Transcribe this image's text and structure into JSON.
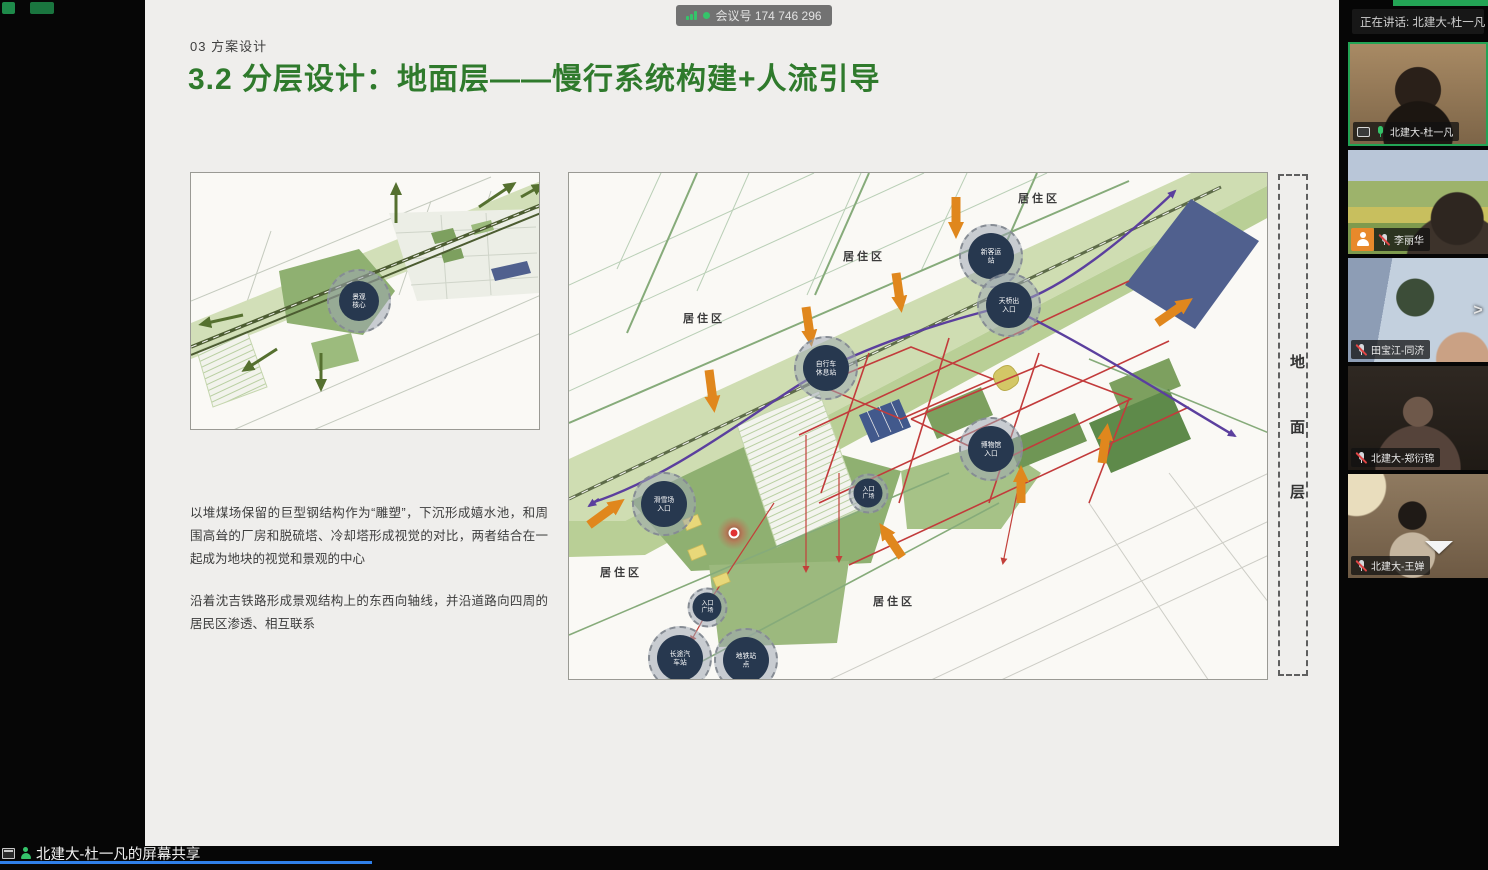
{
  "colors": {
    "title_green": "#2f7a2c",
    "accent_green": "#23a455",
    "flow_orange": "#e0871d",
    "metro_purple": "#5b3f9e",
    "site_red": "#c23b3b",
    "band_green": "#cfddb2",
    "node_navy": "#27384f",
    "taskbar_blue": "#2f7fe8"
  },
  "icons": {
    "signal": "signal-bars-icon",
    "live_dot": "green-dot-icon",
    "mic_on": "mic-icon",
    "mic_muted": "mic-muted-icon",
    "screen_share": "screen-share-icon",
    "hand_raised": "raise-hand-icon",
    "expand": "chevron-right-icon",
    "scroll_more": "triangle-down-icon",
    "window": "window-icon",
    "sharing_user": "person-icon"
  },
  "top_bar": {
    "meeting_label": "会议号 174 746 296"
  },
  "speaking_banner": {
    "text": "正在讲话: 北建大-杜一凡"
  },
  "share_bar": {
    "text": "北建大-杜一凡的屏幕共享"
  },
  "sidebar": {
    "participants": [
      {
        "name": "北建大-杜一凡",
        "mic": "on",
        "sharing": true,
        "speaking": true
      },
      {
        "name": "李丽华",
        "mic": "muted",
        "hand_raised": true
      },
      {
        "name": "田宝江-同济",
        "mic": "muted"
      },
      {
        "name": "北建大-郑衍锦",
        "mic": "muted"
      },
      {
        "name": "北建大-王婵",
        "mic": "muted"
      }
    ]
  },
  "slide": {
    "kicker": "03 方案设计",
    "title": "3.2 分层设计：地面层——慢行系统构建+人流引导",
    "paragraphs": [
      "以堆煤场保留的巨型钢结构作为“雕塑”，下沉形成嬉水池，和周围高耸的厂房和脱硫塔、冷却塔形成视觉的对比，两者结合在一起成为地块的视觉和景观的中心",
      "沿着沈吉铁路形成景观结构上的东西向轴线，并沿道路向四周的居民区渗透、相互联系"
    ],
    "layer_tag": "地面层",
    "small_map": {
      "core_label": "景观核心"
    },
    "main_map": {
      "area_labels": [
        "居住区",
        "居住区",
        "居住区",
        "居住区",
        "居住区"
      ],
      "nodes": [
        {
          "label": "新客运站"
        },
        {
          "label": "天桥出入口"
        },
        {
          "label": "自行车休息站"
        },
        {
          "label": "博物馆入口"
        },
        {
          "label": "入口广场"
        },
        {
          "label": "滑雪场入口"
        },
        {
          "label": "入口广场"
        },
        {
          "label": "长途汽车站"
        },
        {
          "label": "地铁站点"
        }
      ]
    }
  }
}
